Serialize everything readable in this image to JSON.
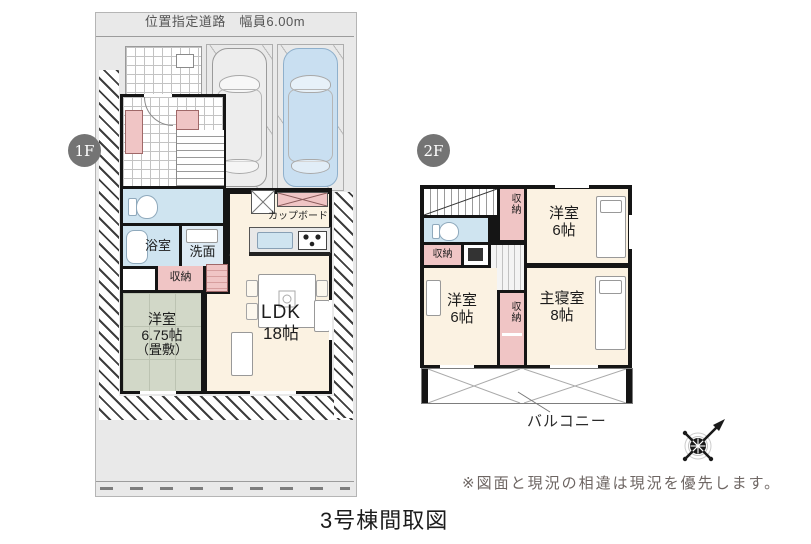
{
  "page": {
    "title": "3号棟間取図",
    "disclaimer": "※図面と現況の相違は現況を優先します。"
  },
  "site": {
    "road_label": "位置指定道路　幅員6.00m"
  },
  "floor1": {
    "badge": "1F",
    "bath": "浴室",
    "washroom": "洗面",
    "storage": "収納",
    "pantry": "パントリー",
    "cupboard": "カップボード",
    "tatami1": "洋室",
    "tatami2": "6.75帖",
    "tatami3": "（畳敷）",
    "ldk1": "LDK",
    "ldk2": "18帖"
  },
  "floor2": {
    "badge": "2F",
    "storage_top": "収納",
    "storage_left": "収納",
    "storage_center": "収納",
    "west_a1": "洋室",
    "west_a2": "6帖",
    "west_b1": "洋室",
    "west_b2": "6帖",
    "master1": "主寝室",
    "master2": "8帖",
    "balcony": "バルコニー"
  },
  "colors": {
    "wall": "#151515",
    "site_gray": "#e9e9e9",
    "room_cream": "#fbf2e2",
    "wet_blue": "#cfe4f0",
    "storage_pink": "#f0c5c5",
    "tatami_green": "#d2d8c8",
    "car_blue": "#c9dff1",
    "badge_gray": "#747474"
  }
}
